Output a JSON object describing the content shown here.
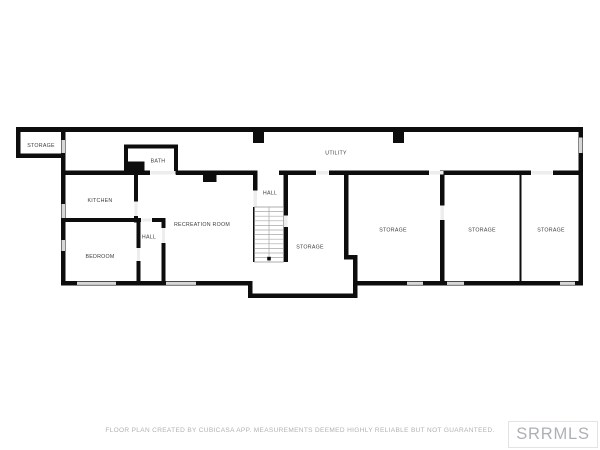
{
  "rooms": {
    "storage_upper_left": "STORAGE",
    "bath": "BATH",
    "kitchen": "KITCHEN",
    "hall_left": "HALL",
    "bedroom": "BEDROOM",
    "recreation_room": "RECREATION ROOM",
    "hall_center": "HALL",
    "utility": "UTILITY",
    "storage_center": "STORAGE",
    "storage_right_1": "STORAGE",
    "storage_right_2": "STORAGE",
    "storage_right_3": "STORAGE"
  },
  "footer": {
    "disclaimer": "FLOOR PLAN CREATED BY CUBICASA APP. MEASUREMENTS DEEMED HIGHLY RELIABLE BUT NOT GUARANTEED.",
    "mls_logo": "SRRMLS"
  },
  "colors": {
    "background": "#ffffff",
    "wall": "#0d0d0d",
    "window_marker": "#d7d7d7",
    "door_marker": "#ededed",
    "label_text": "#3d3d3d",
    "footer_text": "#b3b0b0",
    "logo_text": "#adb1b6",
    "logo_border": "#e3e3e3"
  }
}
